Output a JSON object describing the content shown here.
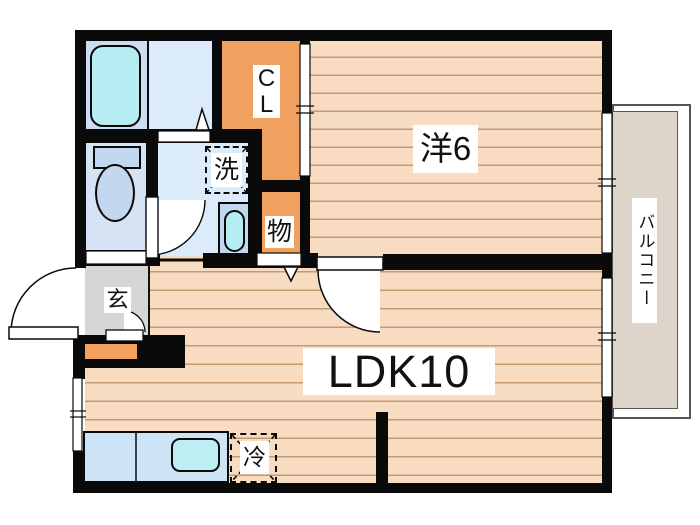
{
  "plan": {
    "rooms": {
      "western": {
        "label": "洋6"
      },
      "ldk": {
        "label": "LDK10"
      },
      "balcony": {
        "label": "バルコニー"
      },
      "closet": {
        "line1": "C",
        "line2": "L"
      },
      "storage": {
        "label": "物"
      },
      "entrance": {
        "label": "玄"
      },
      "washer": {
        "label": "洗"
      },
      "fridge": {
        "label": "冷"
      }
    },
    "colors": {
      "wall": "#0a0a0a",
      "wood_floor": "#f7dcc1",
      "wood_plank_line": "#c49a72",
      "closet_orange": "#f0a160",
      "water_cyan": "#b5edf3",
      "fixture_blue": "#c2d8f0",
      "room_blue": "#dcebfa",
      "bath_blue": "#cbdcf3",
      "toilet_blue": "#d5e3f5",
      "kitchen_blue": "#cde4f7",
      "genkan_gray": "#d6d6d6",
      "balcony_floor": "#ddd5c9"
    }
  }
}
